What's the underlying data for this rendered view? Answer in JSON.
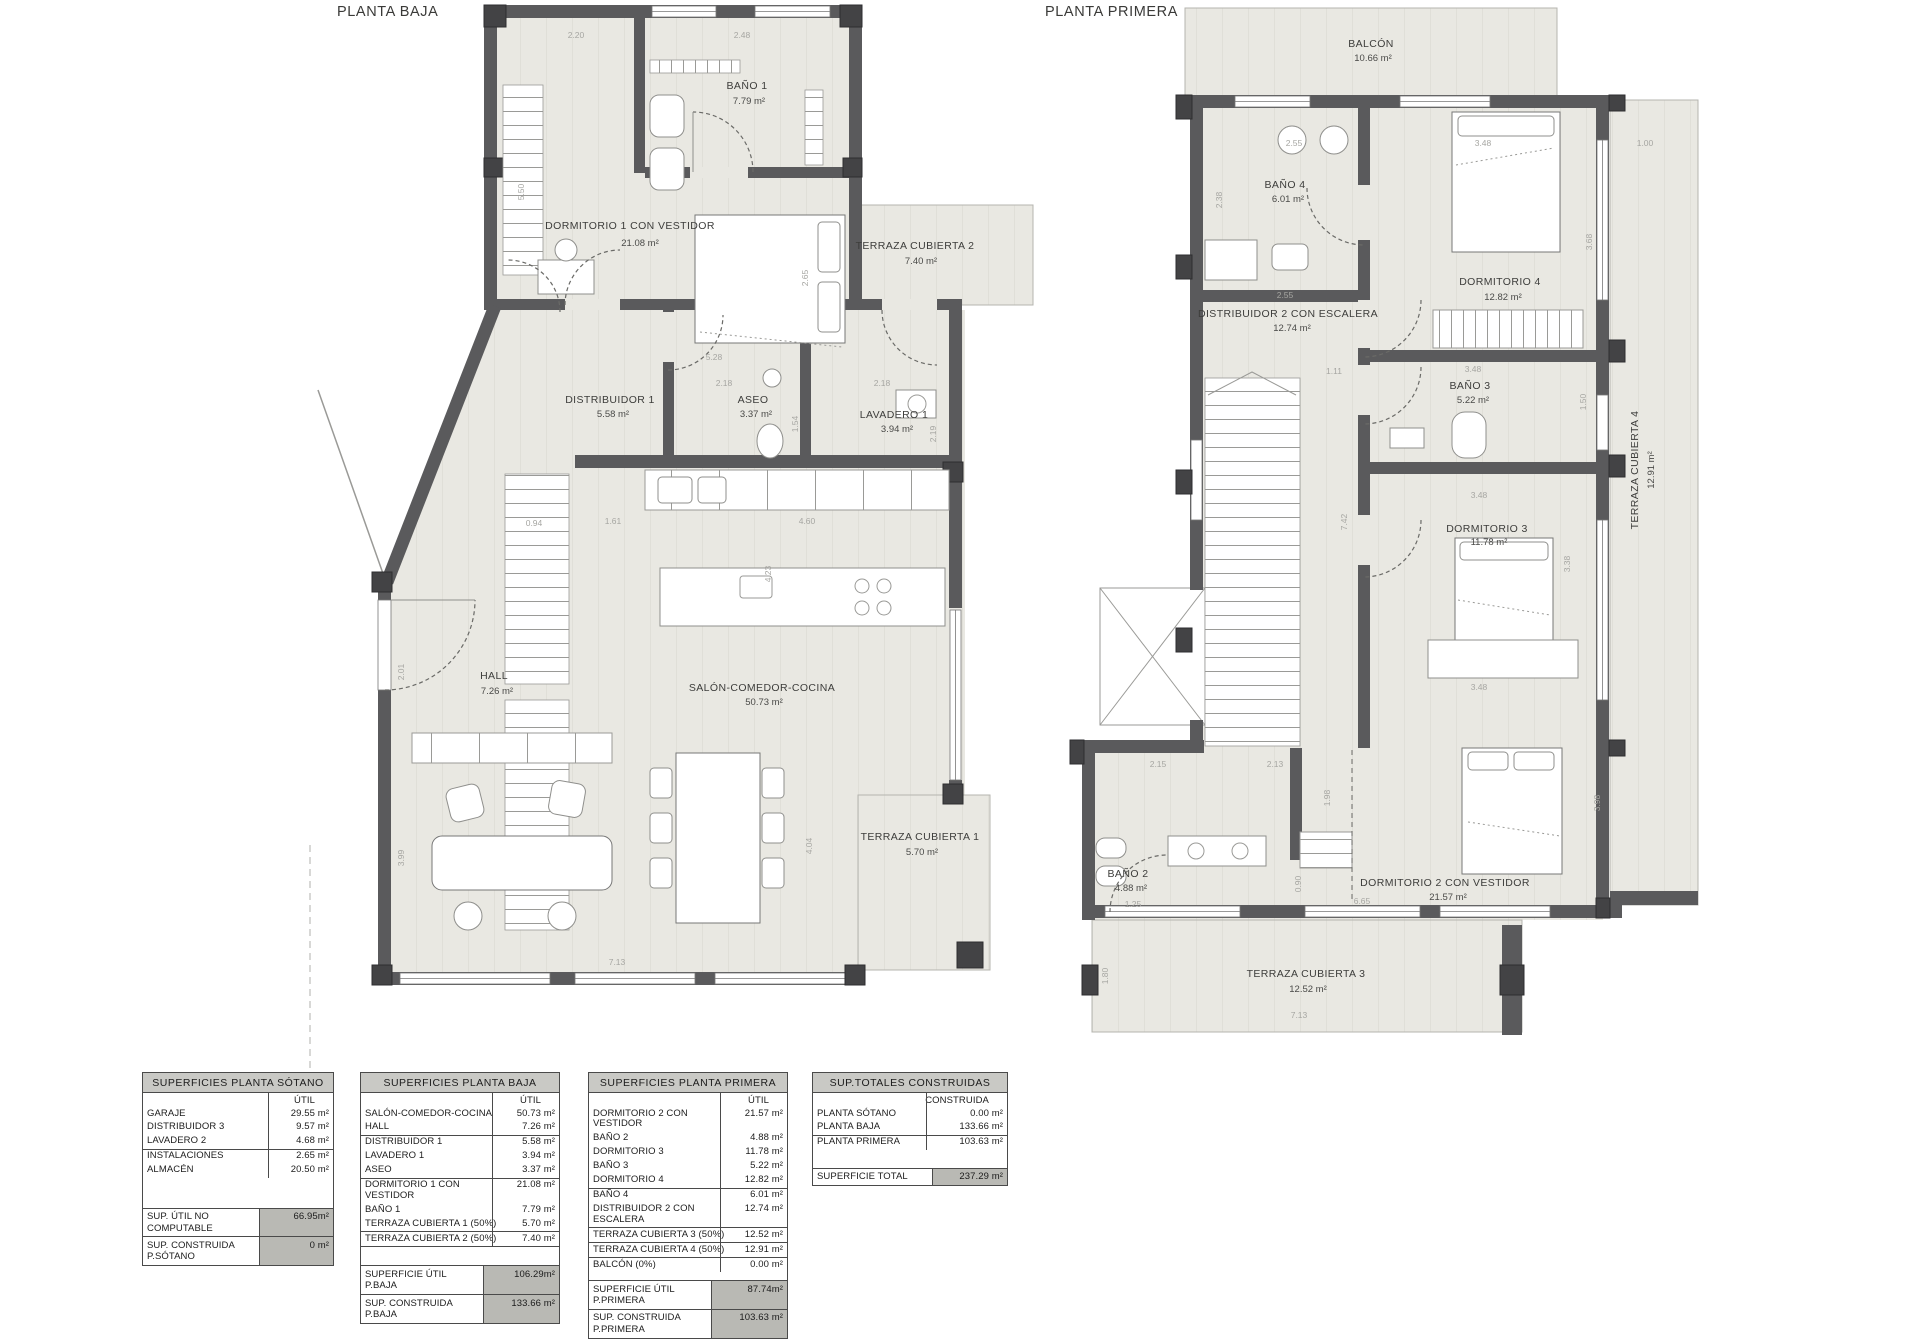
{
  "plans": {
    "baja": {
      "title": "PLANTA BAJA",
      "rooms": {
        "bano1": {
          "name": "BAÑO 1",
          "area": "7.79 m²"
        },
        "dormitorio1": {
          "name": "DORMITORIO 1 CON VESTIDOR",
          "area": "21.08 m²"
        },
        "terraza2": {
          "name": "TERRAZA CUBIERTA 2",
          "area": "7.40 m²"
        },
        "distribuidor1": {
          "name": "DISTRIBUIDOR 1",
          "area": "5.58 m²"
        },
        "aseo": {
          "name": "ASEO",
          "area": "3.37 m²"
        },
        "lavadero1": {
          "name": "LAVADERO 1",
          "area": "3.94 m²"
        },
        "hall": {
          "name": "HALL",
          "area": "7.26 m²"
        },
        "salon": {
          "name": "SALÓN-COMEDOR-COCINA",
          "area": "50.73 m²"
        },
        "terraza1": {
          "name": "TERRAZA CUBIERTA 1",
          "area": "5.70 m²"
        }
      },
      "dims": [
        "2.20",
        "2.48",
        "5.50",
        "2.65",
        "5.28",
        "2.18",
        "2.18",
        "1.54",
        "2.19",
        "1.61",
        "0.94",
        "4.60",
        "4.23",
        "2.01",
        "3.99",
        "4.04",
        "7.13"
      ]
    },
    "primera": {
      "title": "PLANTA PRIMERA",
      "rooms": {
        "balcon": {
          "name": "BALCÓN",
          "area": "10.66 m²"
        },
        "bano4": {
          "name": "BAÑO 4",
          "area": "6.01 m²"
        },
        "dormitorio4": {
          "name": "DORMITORIO 4",
          "area": "12.82 m²"
        },
        "distribuidor2": {
          "name": "DISTRIBUIDOR 2 CON ESCALERA",
          "area": "12.74 m²"
        },
        "bano3": {
          "name": "BAÑO 3",
          "area": "5.22 m²"
        },
        "dormitorio3": {
          "name": "DORMITORIO 3",
          "area": "11.78 m²"
        },
        "terraza4": {
          "name": "TERRAZA CUBIERTA 4",
          "area": "12.91 m²"
        },
        "bano2": {
          "name": "BAÑO 2",
          "area": "4.88 m²"
        },
        "dormitorio2": {
          "name": "DORMITORIO 2 CON VESTIDOR",
          "area": "21.57 m²"
        },
        "terraza3": {
          "name": "TERRAZA CUBIERTA 3",
          "area": "12.52 m²"
        }
      },
      "dims": [
        "2.55",
        "2.38",
        "3.48",
        "1.00",
        "2.55",
        "3.68",
        "1.11",
        "3.48",
        "1.50",
        "7.42",
        "3.48",
        "3.38",
        "3.48",
        "2.15",
        "2.13",
        "1.98",
        "0.90",
        "6.65",
        "3.98",
        "1.25",
        "1.80",
        "7.13"
      ]
    }
  },
  "tables": {
    "sotano": {
      "title": "SUPERFICIES PLANTA SÓTANO",
      "col": "ÚTIL",
      "rows": [
        {
          "label": "GARAJE",
          "value": "29.55 m²"
        },
        {
          "label": "DISTRIBUIDOR 3",
          "value": "9.57 m²"
        },
        {
          "label": "LAVADERO 2",
          "value": "4.68 m²"
        },
        {
          "label": "INSTALACIONES",
          "value": "2.65 m²"
        },
        {
          "label": "ALMACÉN",
          "value": "20.50 m²"
        }
      ],
      "totals": [
        {
          "label": "SUP. ÚTIL NO COMPUTABLE",
          "value": "66.95m²"
        },
        {
          "label": "SUP. CONSTRUIDA P.SÓTANO",
          "value": "0 m²"
        }
      ]
    },
    "baja": {
      "title": "SUPERFICIES PLANTA BAJA",
      "col": "ÚTIL",
      "rows": [
        {
          "label": "SALÓN-COMEDOR-COCINA",
          "value": "50.73 m²"
        },
        {
          "label": "HALL",
          "value": "7.26 m²"
        },
        {
          "label": "DISTRIBUIDOR 1",
          "value": "5.58 m²"
        },
        {
          "label": "LAVADERO 1",
          "value": "3.94 m²"
        },
        {
          "label": "ASEO",
          "value": "3.37 m²"
        },
        {
          "label": "DORMITORIO 1 CON VESTIDOR",
          "value": "21.08 m²"
        },
        {
          "label": "BAÑO 1",
          "value": "7.79 m²"
        },
        {
          "label": "TERRAZA CUBIERTA 1 (50%)",
          "value": "5.70 m²"
        },
        {
          "label": "TERRAZA CUBIERTA 2 (50%)",
          "value": "7.40 m²"
        }
      ],
      "totals": [
        {
          "label": "SUPERFICIE ÚTIL P.BAJA",
          "value": "106.29m²"
        },
        {
          "label": "SUP. CONSTRUIDA P.BAJA",
          "value": "133.66 m²"
        }
      ]
    },
    "primera": {
      "title": "SUPERFICIES PLANTA PRIMERA",
      "col": "ÚTIL",
      "rows": [
        {
          "label": "DORMITORIO 2 CON VESTIDOR",
          "value": "21.57 m²"
        },
        {
          "label": "BAÑO 2",
          "value": "4.88 m²"
        },
        {
          "label": "DORMITORIO 3",
          "value": "11.78 m²"
        },
        {
          "label": "BAÑO 3",
          "value": "5.22 m²"
        },
        {
          "label": "DORMITORIO 4",
          "value": "12.82 m²"
        },
        {
          "label": "BAÑO 4",
          "value": "6.01 m²"
        },
        {
          "label": "DISTRIBUIDOR 2 CON ESCALERA",
          "value": "12.74 m²"
        },
        {
          "label": "TERRAZA CUBIERTA 3 (50%)",
          "value": "12.52 m²"
        },
        {
          "label": "TERRAZA CUBIERTA 4 (50%)",
          "value": "12.91 m²"
        },
        {
          "label": "BALCÓN (0%)",
          "value": "0.00 m²"
        }
      ],
      "totals": [
        {
          "label": "SUPERFICIE ÚTIL P.PRIMERA",
          "value": "87.74m²"
        },
        {
          "label": "SUP. CONSTRUIDA P.PRIMERA",
          "value": "103.63 m²"
        }
      ]
    },
    "totales": {
      "title": "SUP.TOTALES CONSTRUIDAS",
      "col": "CONSTRUIDA",
      "rows": [
        {
          "label": "PLANTA SÓTANO",
          "value": "0.00 m²"
        },
        {
          "label": "PLANTA BAJA",
          "value": "133.66 m²"
        },
        {
          "label": "PLANTA PRIMERA",
          "value": "103.63 m²"
        }
      ],
      "totals": [
        {
          "label": "SUPERFICIE TOTAL",
          "value": "237.29 m²"
        }
      ]
    }
  },
  "colors": {
    "wall": "#5a5a5c",
    "floor": "#e9e8e2",
    "accentPillar": "#434345",
    "totalCell": "#b9b9b4",
    "tableHeader": "#c9c9c5"
  }
}
